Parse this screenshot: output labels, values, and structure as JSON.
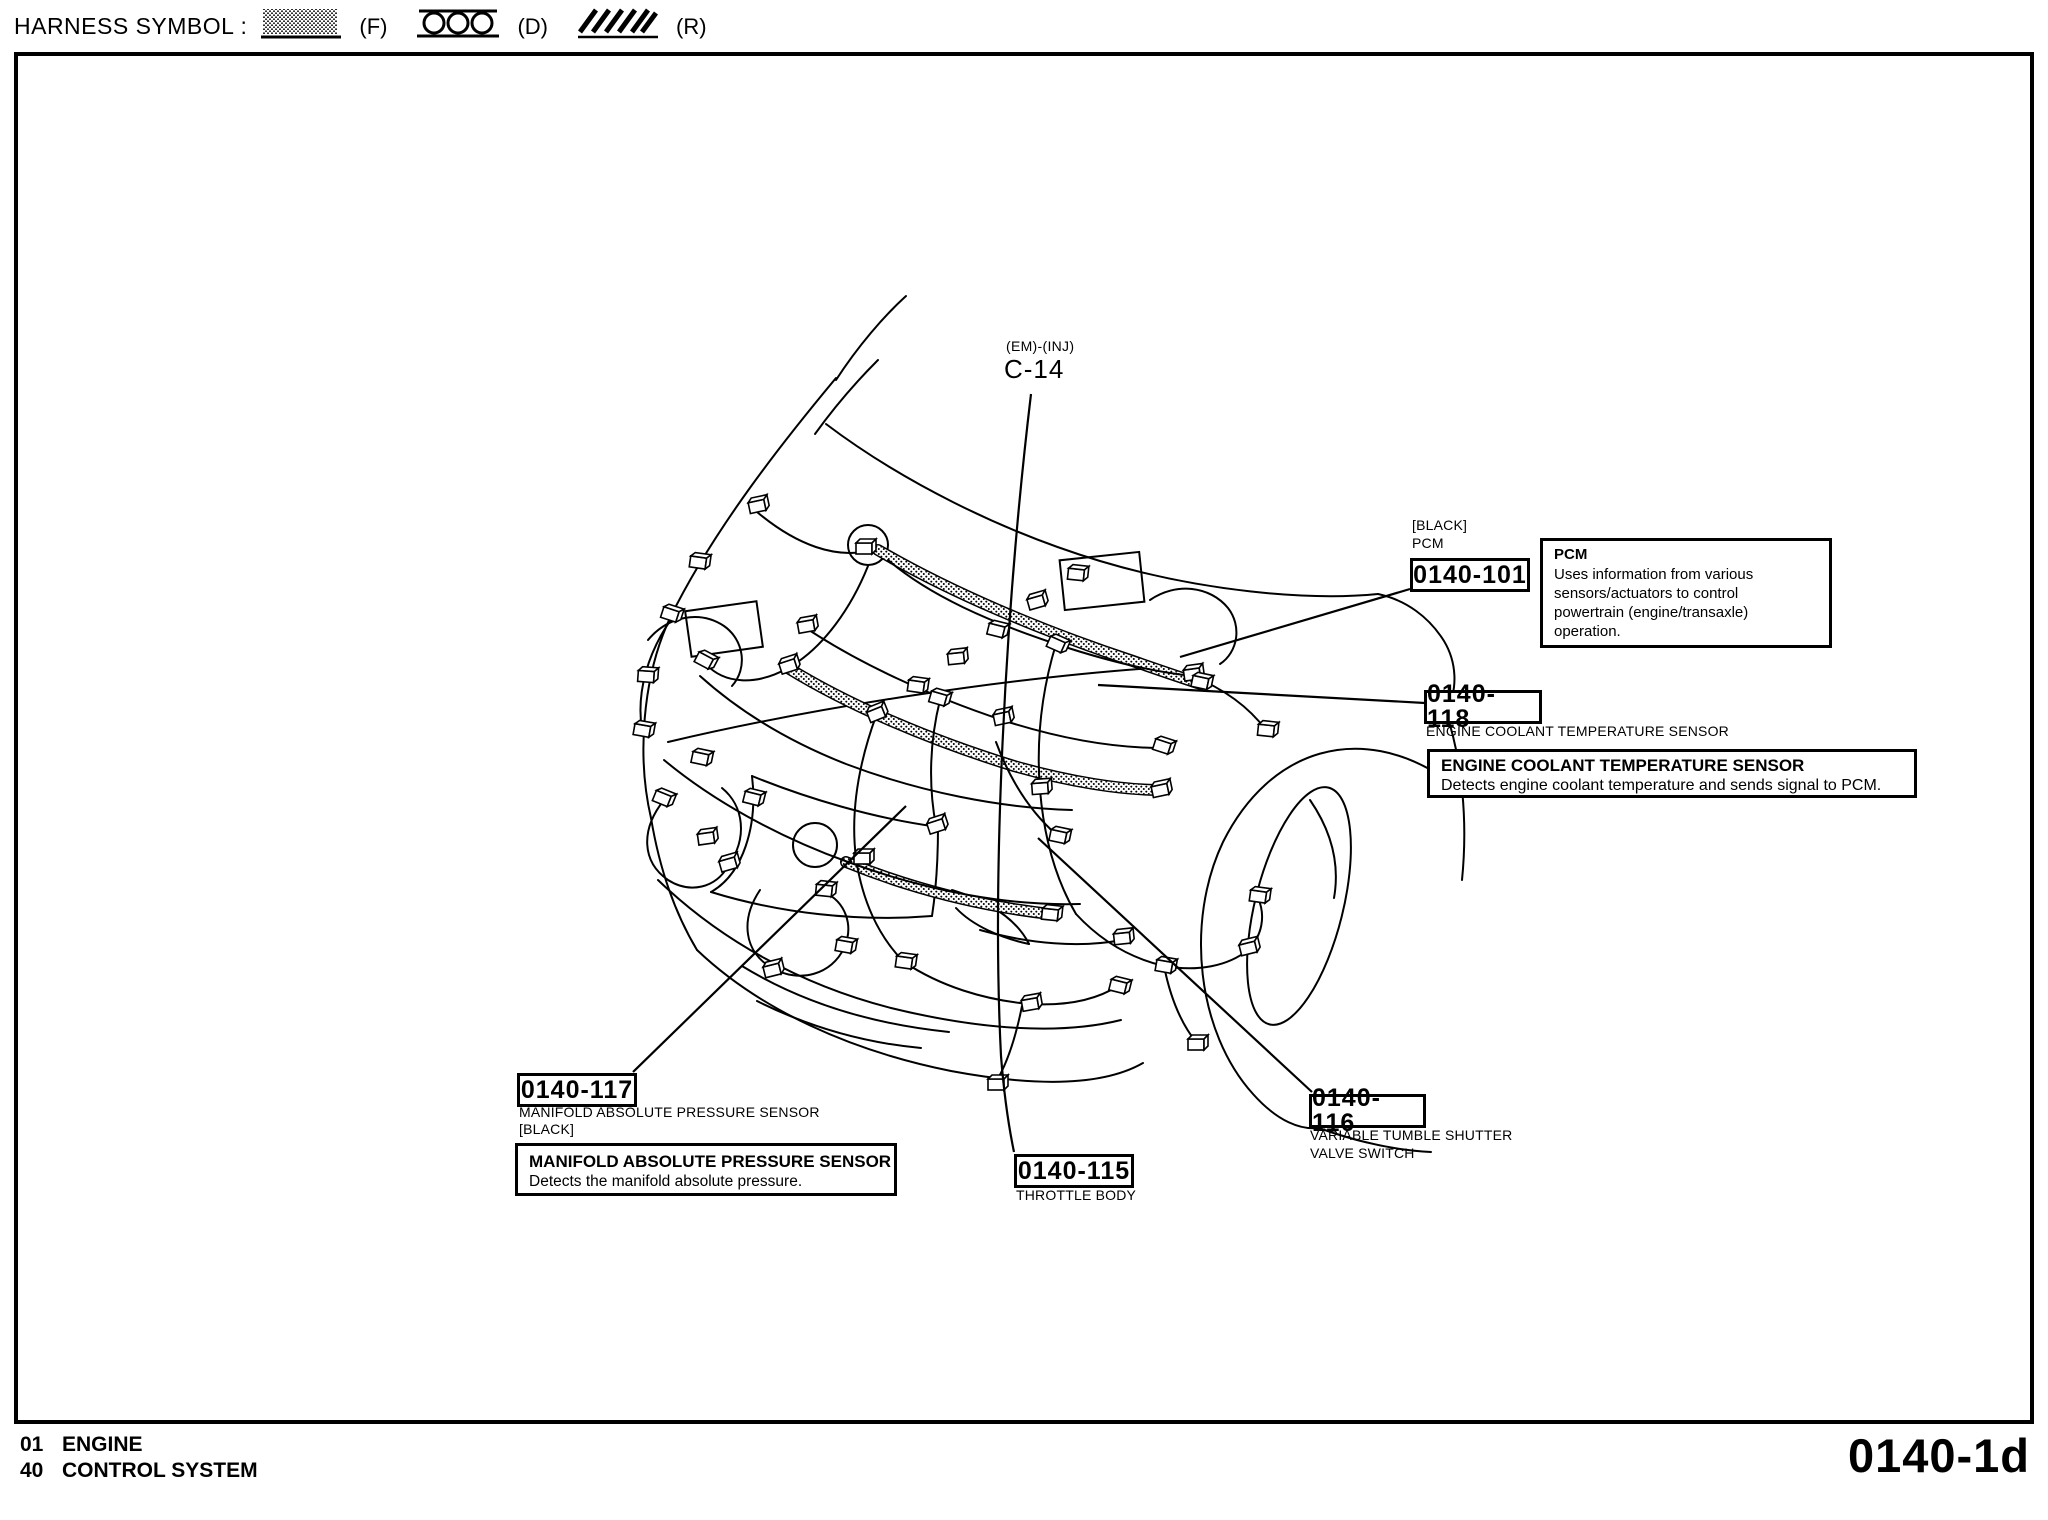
{
  "header": {
    "label": "HARNESS SYMBOL :",
    "patterns": [
      {
        "name": "stipple",
        "label": "(F)"
      },
      {
        "name": "circles",
        "label": "(D)"
      },
      {
        "name": "diagonal-hatch",
        "label": "(R)"
      }
    ]
  },
  "diagram": {
    "connector_ref": {
      "harness": "(EM)-(INJ)",
      "code": "C-14"
    },
    "callouts": {
      "pcm": {
        "note": "[BLACK]",
        "name": "PCM",
        "code": "0140-101"
      },
      "ect": {
        "code": "0140-118",
        "label": "ENGINE COOLANT TEMPERATURE SENSOR"
      },
      "map": {
        "code": "0140-117",
        "label": "MANIFOLD ABSOLUTE PRESSURE SENSOR",
        "note": "[BLACK]"
      },
      "throttle_body": {
        "code": "0140-115",
        "label": "THROTTLE BODY"
      },
      "vts": {
        "code": "0140-116",
        "label_line1": "VARIABLE TUMBLE SHUTTER",
        "label_line2": "VALVE SWITCH"
      }
    },
    "info_boxes": {
      "pcm": {
        "title": "PCM",
        "lines": [
          "Uses information from various",
          "sensors/actuators to control",
          "powertrain (engine/transaxle)",
          "operation."
        ]
      },
      "ect": {
        "title": "ENGINE COOLANT TEMPERATURE SENSOR",
        "body": "Detects engine coolant temperature and sends signal to PCM."
      },
      "map": {
        "title": "MANIFOLD ABSOLUTE PRESSURE SENSOR",
        "body": "Detects the manifold absolute pressure."
      }
    }
  },
  "footer": {
    "rows": [
      {
        "code": "01",
        "name": "ENGINE"
      },
      {
        "code": "40",
        "name": "CONTROL SYSTEM"
      }
    ],
    "page_id": "0140-1d"
  },
  "colors": {
    "ink": "#000000",
    "paper": "#ffffff"
  }
}
